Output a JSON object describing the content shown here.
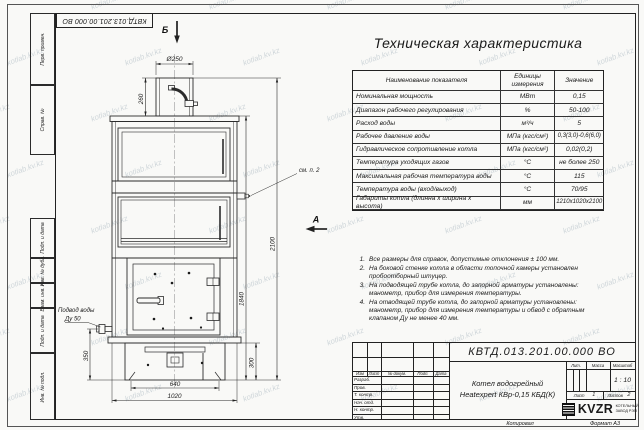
{
  "sheet": {
    "watermark": "kotlab.kv.kz",
    "copied_label": "Копировал",
    "format_label": "Формат А3"
  },
  "margin_labels": {
    "perv": "Перв. примен.",
    "sprav": "Справ. №",
    "podp1": "Подп. и дата",
    "inv_dubl": "Инв. № дубл.",
    "vzam": "Взам. инв. №",
    "podp2": "Подп. и дата",
    "inv_podl": "Инв. № подл."
  },
  "drawing": {
    "section_label_top": "Б",
    "view_label_side": "А",
    "callout_note2": "см. п. 2",
    "water_inlet": {
      "line1": "Подвод воды",
      "line2": "Ду 50"
    },
    "dims": {
      "chimney_dia": "Ø250",
      "chimney_height": "260",
      "body_height": "1840",
      "total_height": "2100",
      "inlet_height": "350",
      "base_height": "300",
      "base_width": "640",
      "body_width": "1020"
    }
  },
  "spec_table": {
    "title": "Техническая характеристика",
    "headers": {
      "name": "Наименование показателя",
      "unit": "Единицы измерения",
      "value": "Значение"
    },
    "rows": [
      {
        "name": "Номинальная мощность",
        "unit": "МВт",
        "value": "0,15"
      },
      {
        "name": "Диапазон рабочего регулирования",
        "unit": "%",
        "value": "50-100"
      },
      {
        "name": "Расход воды",
        "unit": "м³/ч",
        "value": "5"
      },
      {
        "name": "Рабочее давление воды",
        "unit": "МПа (кгс/см²)",
        "value": "0,3(3,0)-0,6(6,0)"
      },
      {
        "name": "Гидравлическое сопротивление котла",
        "unit": "МПа (кгс/см²)",
        "value": "0,02(0,2)"
      },
      {
        "name": "Температура уходящих газов",
        "unit": "°С",
        "value": "не более 250"
      },
      {
        "name": "Максимальная рабочая температура воды",
        "unit": "°С",
        "value": "115"
      },
      {
        "name": "Температура воды (вход/выход)",
        "unit": "°С",
        "value": "70/95"
      },
      {
        "name": "Габариты котла (длинна х ширина х высота)",
        "unit": "мм",
        "value": "1210х1020х2100"
      }
    ]
  },
  "notes": [
    {
      "num": "1.",
      "text": "Все размеры для справок, допустимые отклонения ± 100 мм."
    },
    {
      "num": "2.",
      "text": "На боковой стенке котла в области топочной камеры установлен пробоотборный штуцер."
    },
    {
      "num": "3.",
      "text": "На подводящей трубе котла, до запорной арматуры установлены: манометр, прибор для измерения температуры."
    },
    {
      "num": "4.",
      "text": "На отводящей трубе котла, до запорной арматуры установлены: манометр, прибор для измерения температуры и обвод с обратным клапаном Ду не менее 40 мм."
    }
  ],
  "title_block": {
    "doc_number": "КВТД.013.201.00.000 ВО",
    "rev_cols": {
      "izm": "Изм",
      "list": "Лист",
      "docnum": "№ докум.",
      "podp": "Подп.",
      "data": "Дата"
    },
    "roles": [
      "Разраб.",
      "Пров.",
      "Т. контр.",
      "Нач. отд.",
      "Н. контр.",
      "Утв."
    ],
    "product": {
      "line1": "Котел водогрейный",
      "line2": "Heatexpert КВр-0,15 КБД(К)"
    },
    "lit_label": "Лит.",
    "mass_label": "Масса",
    "scale_label": "Масштаб",
    "scale_value": "1 : 10",
    "sheet_label": "Лист",
    "sheet_num": "1",
    "sheets_label": "Листов",
    "sheets_num": "2",
    "logo": {
      "abbr": "KVZR",
      "company_line1": "КОТЕЛЬНЫЙ",
      "company_line2": "ЗАВОД  РЭП"
    }
  }
}
